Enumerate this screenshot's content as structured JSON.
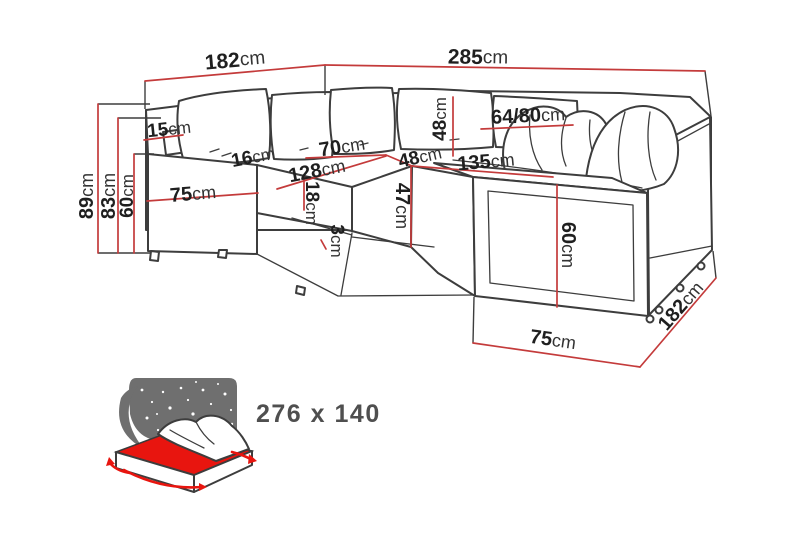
{
  "page": {
    "background": "#ffffff"
  },
  "colors": {
    "dimension_red": "#c43b3b",
    "outline_gray": "#3d3d3d",
    "label_dark": "#1f1f1f",
    "icon_gray": "#6f6f6f",
    "mattress_red": "#e8150f"
  },
  "diagram": {
    "type": "furniture-dimension-diagram",
    "subject": "corner-sofa-bed",
    "dimensions": [
      {
        "id": "width-left-top",
        "value": "182",
        "unit": "cm"
      },
      {
        "id": "width-right-top",
        "value": "285",
        "unit": "cm"
      },
      {
        "id": "height-total",
        "value": "89",
        "unit": "cm"
      },
      {
        "id": "height-backrest",
        "value": "83",
        "unit": "cm"
      },
      {
        "id": "height-armrest-left",
        "value": "60",
        "unit": "cm"
      },
      {
        "id": "armrest-top-width",
        "value": "15",
        "unit": "cm"
      },
      {
        "id": "backrest-top-depth",
        "value": "16",
        "unit": "cm"
      },
      {
        "id": "arm-section-width",
        "value": "75",
        "unit": "cm"
      },
      {
        "id": "seat-width-left",
        "value": "128",
        "unit": "cm"
      },
      {
        "id": "corner-seat-width",
        "value": "70",
        "unit": "cm"
      },
      {
        "id": "seat-cushion-thickness",
        "value": "18",
        "unit": "cm"
      },
      {
        "id": "corner-gap",
        "value": "3",
        "unit": "cm"
      },
      {
        "id": "corner-seat-depth",
        "value": "48",
        "unit": "cm"
      },
      {
        "id": "back-cushion-height",
        "value": "48",
        "unit": "cm"
      },
      {
        "id": "back-cushion-width",
        "value": "64/80",
        "unit": "cm"
      },
      {
        "id": "seat-width-right",
        "value": "135",
        "unit": "cm"
      },
      {
        "id": "seat-height-front",
        "value": "47",
        "unit": "cm"
      },
      {
        "id": "height-armrest-right",
        "value": "60",
        "unit": "cm"
      },
      {
        "id": "return-width-bottom",
        "value": "75",
        "unit": "cm"
      },
      {
        "id": "depth-right-bottom",
        "value": "182",
        "unit": "cm"
      }
    ],
    "sleeping_area": {
      "label": "276 x 140"
    }
  }
}
